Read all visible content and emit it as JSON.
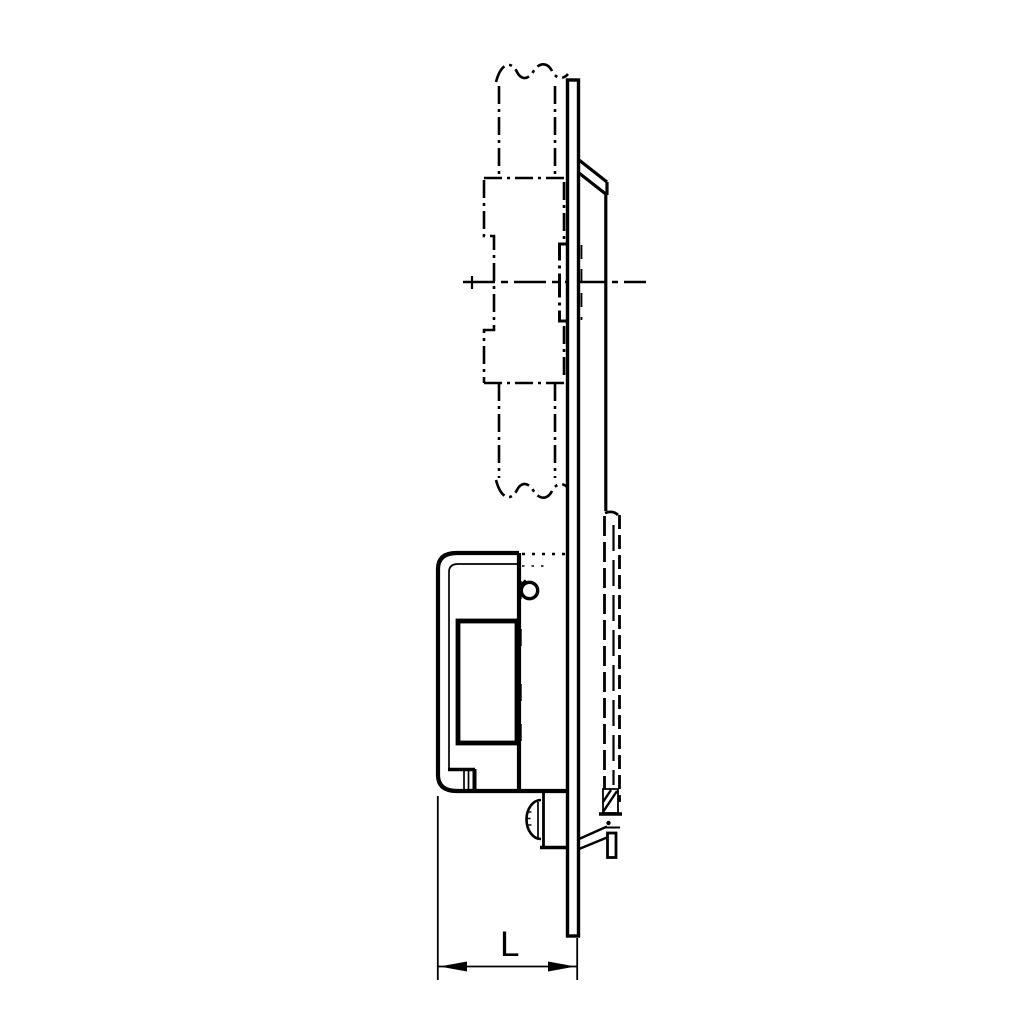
{
  "diagram": {
    "background_color": "#ffffff",
    "line_color": "#000000",
    "dimension": {
      "label": "L"
    }
  }
}
